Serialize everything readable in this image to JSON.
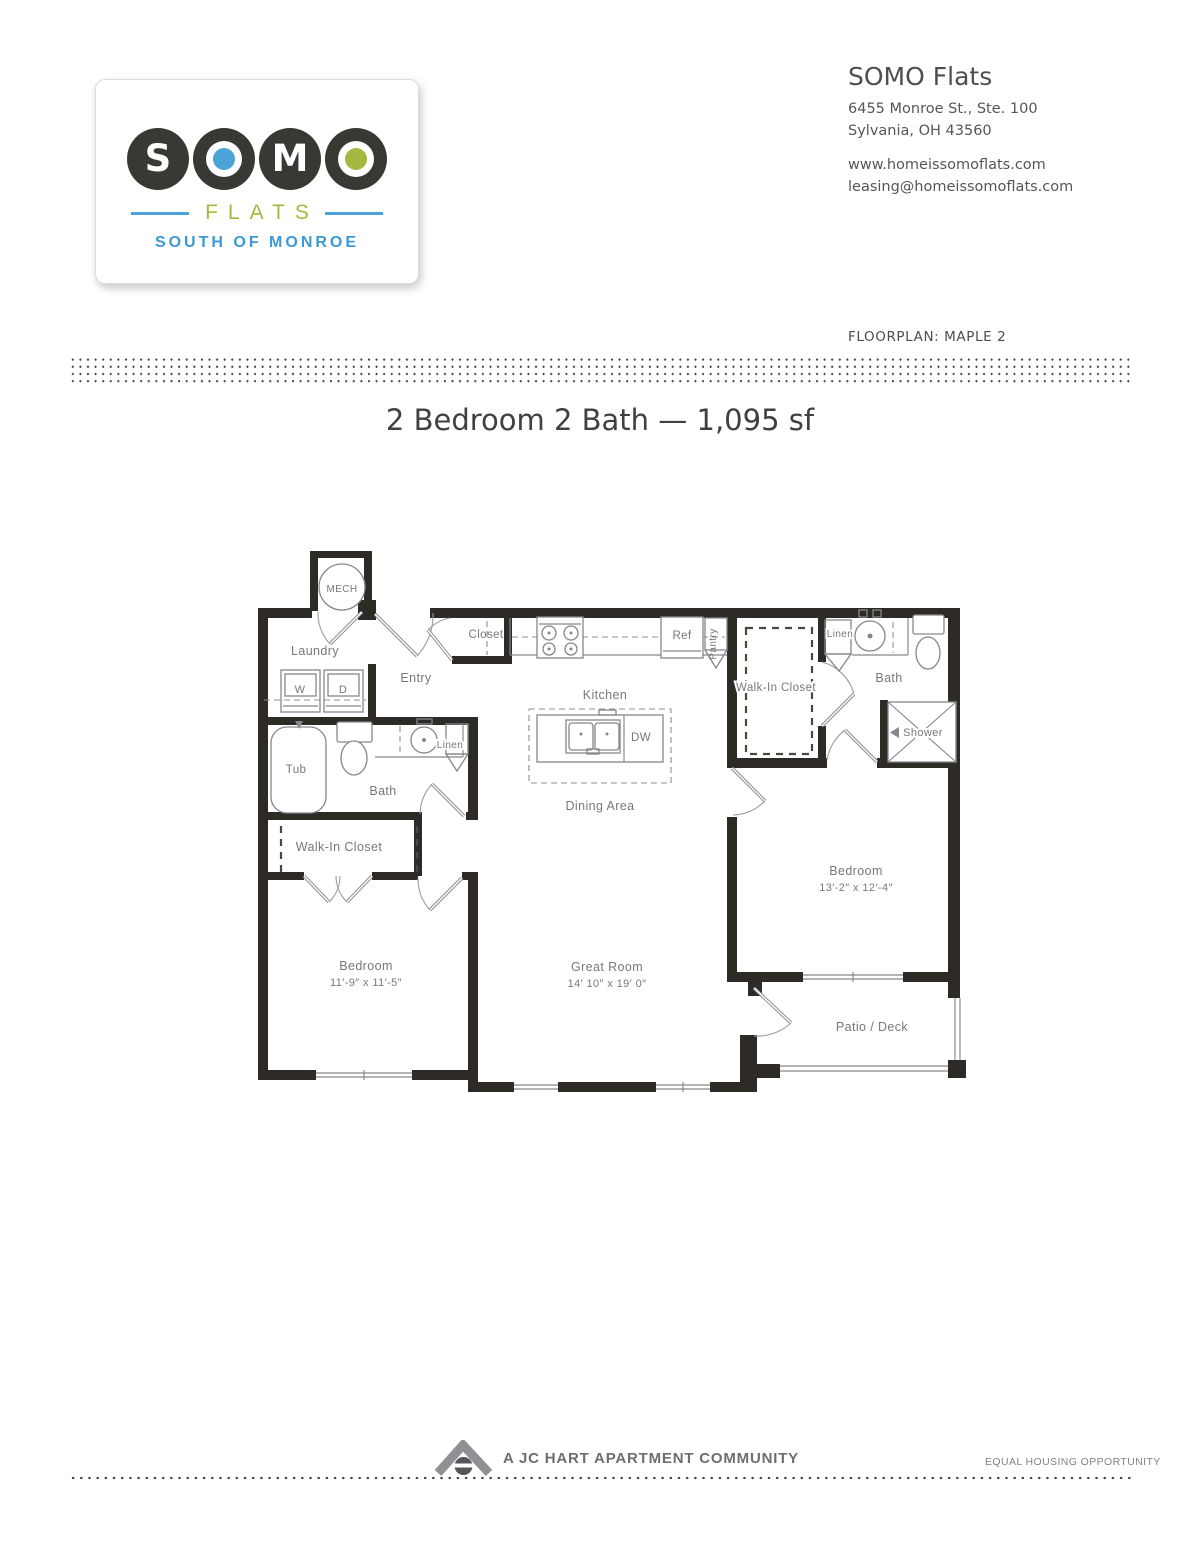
{
  "header": {
    "logo": {
      "word": "SOMO",
      "letters": [
        "S",
        "O",
        "M",
        "O"
      ],
      "flats": "FLATS",
      "tagline": "SOUTH OF MONROE"
    },
    "contact": {
      "name": "SOMO Flats",
      "address1": "6455 Monroe St., Ste. 100",
      "address2": "Sylvania, OH 43560",
      "website": "www.homeissomoflats.com",
      "email": "leasing@homeissomoflats.com"
    },
    "floorplan_label": "FLOORPLAN: MAPLE 2"
  },
  "title": "2 Bedroom 2 Bath — 1,095 sf",
  "floorplan": {
    "labels": {
      "mech": "MECH",
      "laundry": "Laundry",
      "washer": "W",
      "dryer": "D",
      "entry": "Entry",
      "closet": "Closet",
      "kitchen": "Kitchen",
      "ref": "Ref",
      "pantry": "Pantry",
      "dw": "DW",
      "linen_left": "Linen",
      "tub": "Tub",
      "bath_left": "Bath",
      "wic_left": "Walk-In Closet",
      "dining": "Dining Area",
      "bedroom_left": "Bedroom",
      "bedroom_left_dims": "11′-9″ x 11′-5″",
      "great_room": "Great Room",
      "great_room_dims": "14′ 10″ x 19′ 0″",
      "wic_right": "Walk-In Closet",
      "linen_right": "Linen",
      "bath_right": "Bath",
      "shower": "Shower",
      "bedroom_right": "Bedroom",
      "bedroom_right_dims": "13′-2″ x 12′-4″",
      "patio": "Patio / Deck"
    }
  },
  "footer": {
    "community": "A JC HART APARTMENT COMMUNITY",
    "equal_housing": "EQUAL HOUSING OPPORTUNITY"
  },
  "colors": {
    "logo_circle_dark": "#3A3833",
    "logo_dot_blue": "#4BA3D7",
    "logo_dot_green": "#A5B940",
    "flats_text_green": "#A6B93C",
    "tagline_blue": "#3D99D5",
    "title_text": "#3E4042",
    "body_text": "#55565A",
    "plan_wall": "#2E2B27",
    "plan_line_gray": "#85878A",
    "plan_label_gray": "#76787B",
    "footer_gray": "#6D6E71",
    "dot_leader": "#43454A"
  }
}
